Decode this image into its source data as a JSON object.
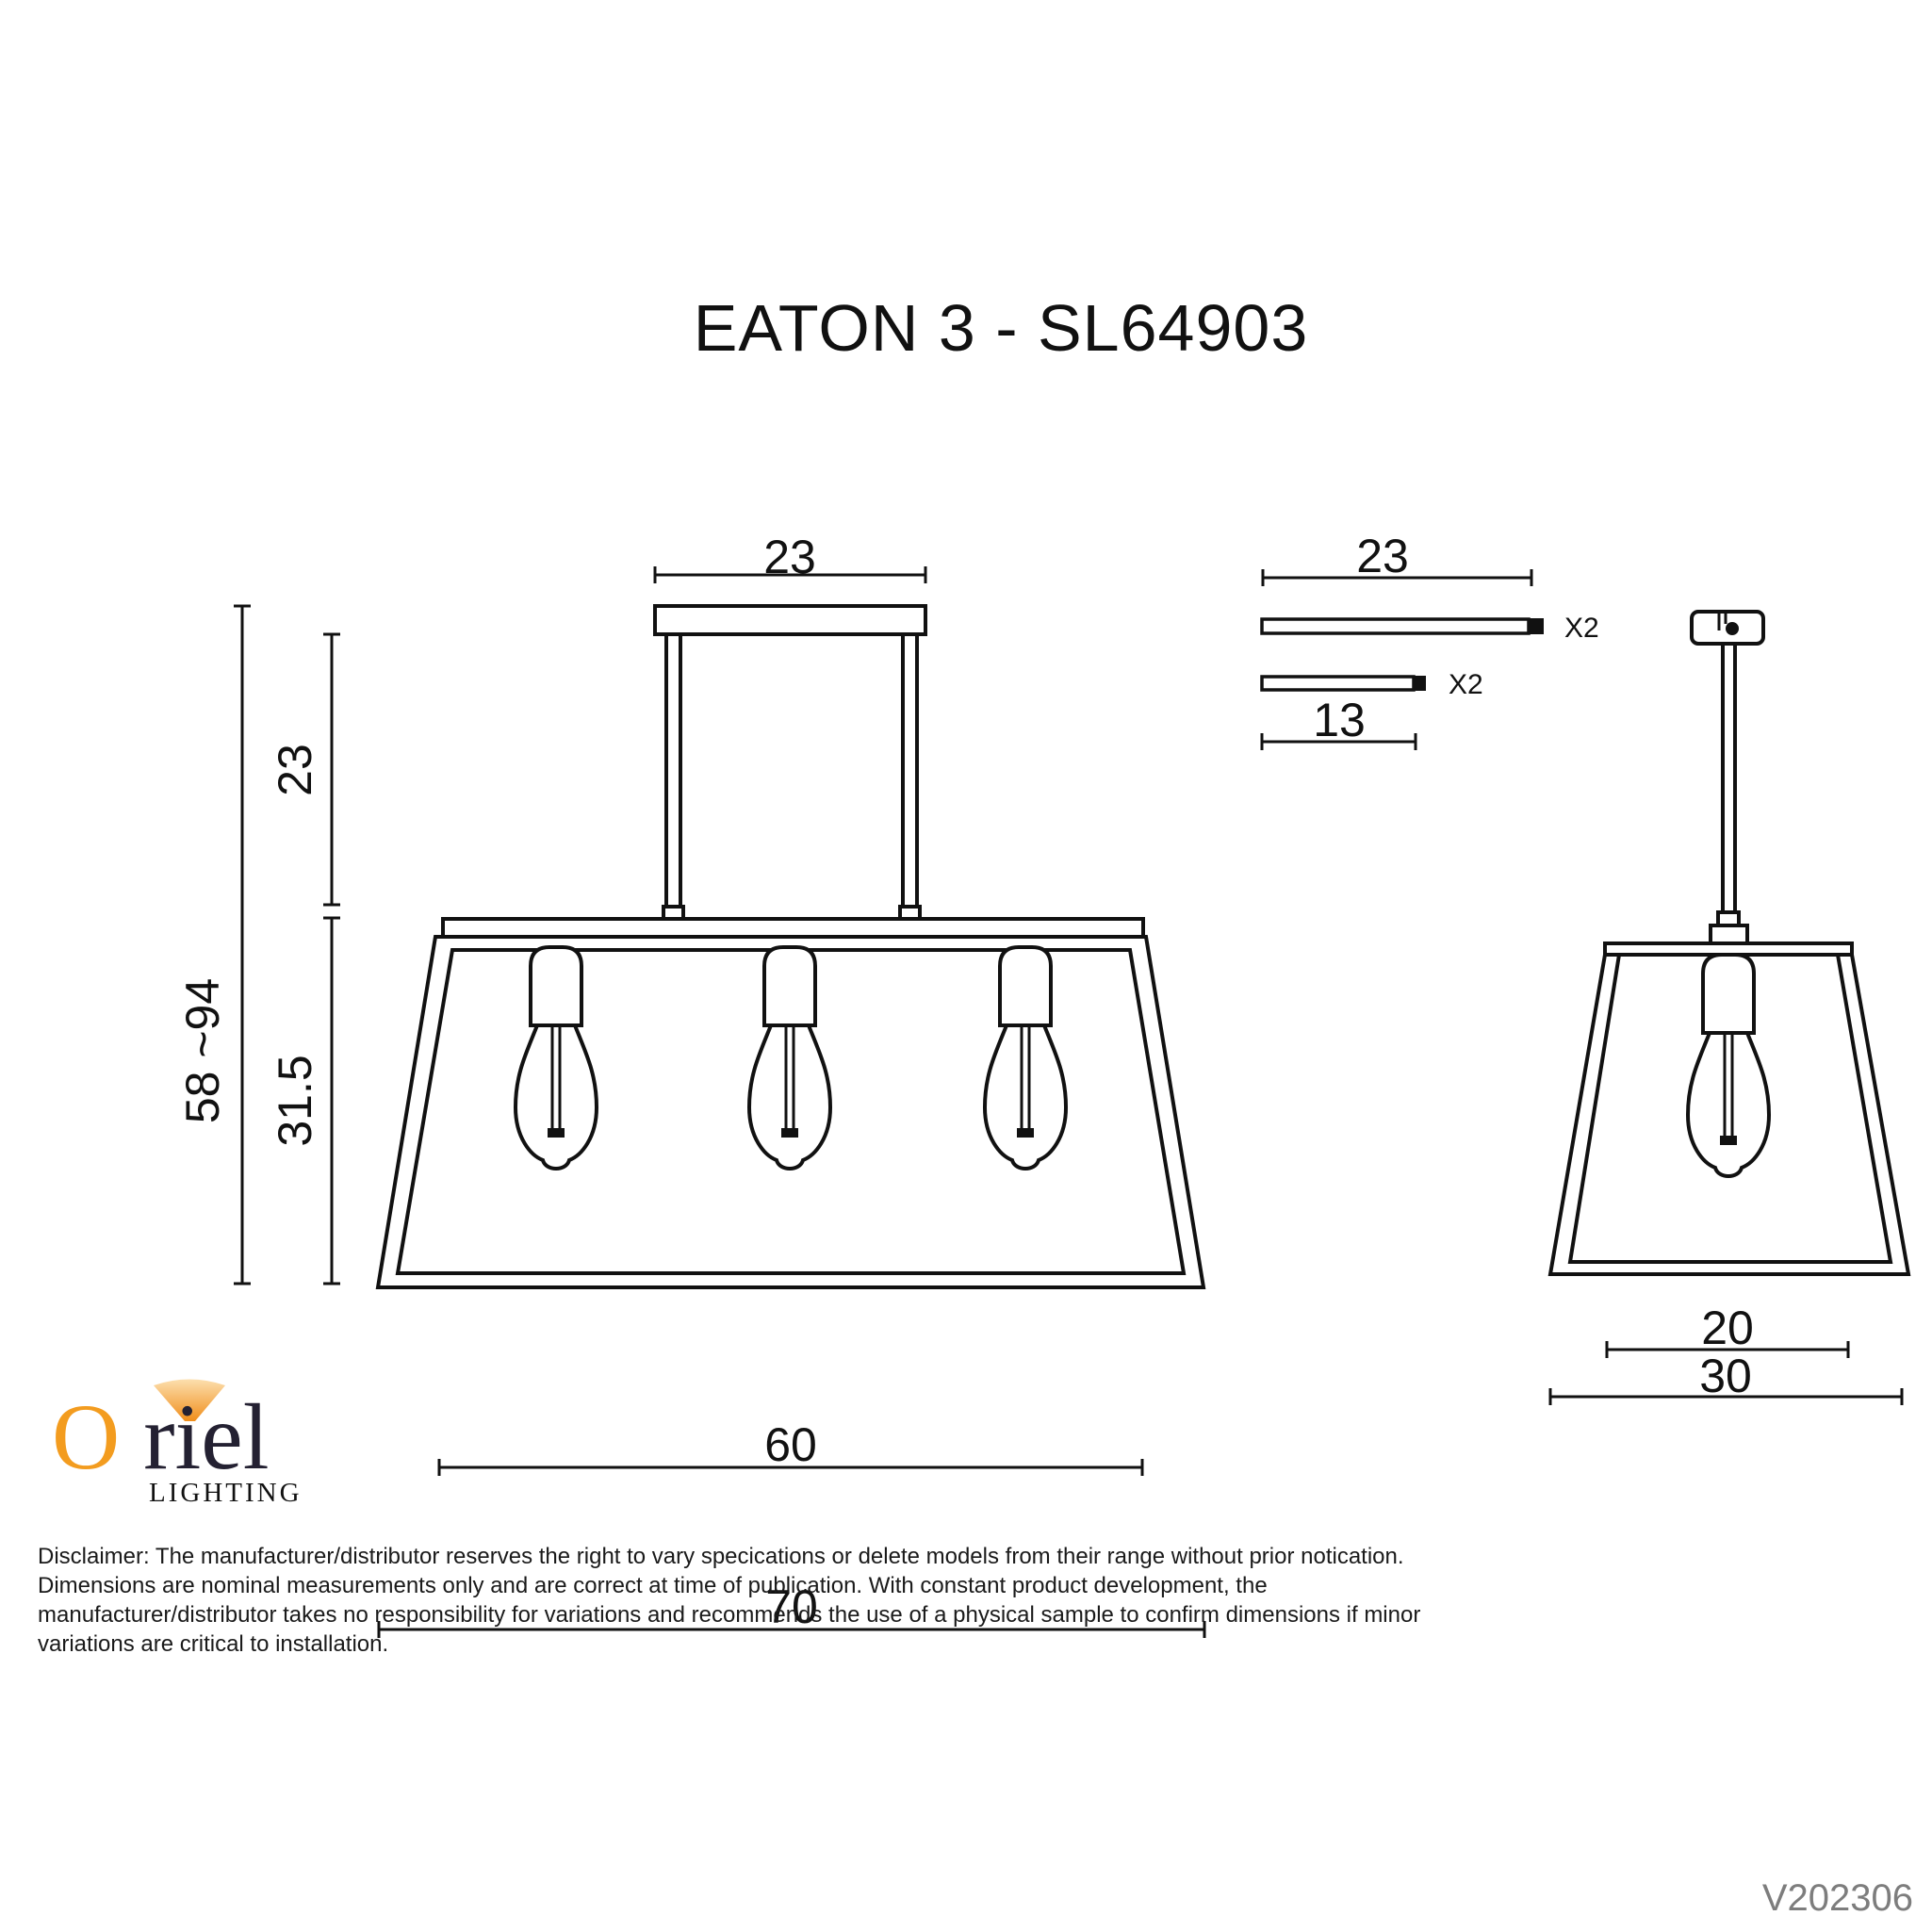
{
  "title": "EATON 3 - SL64903",
  "front_view": {
    "dim_canopy_width": "23",
    "dim_rod_length": "23",
    "dim_overall_height": "58 ~94",
    "dim_shade_height": "31.5",
    "dim_shade_top_width": "60",
    "dim_shade_overall_width": "70"
  },
  "parts": {
    "long_rod": {
      "length": "23",
      "qty": "X2"
    },
    "short_rod": {
      "length": "13",
      "qty": "X2"
    }
  },
  "side_view": {
    "dim_shade_top_depth": "20",
    "dim_shade_bottom_depth": "30"
  },
  "logo": {
    "brand_initial": "O",
    "brand_rest": "riel",
    "tagline": "LIGHTING"
  },
  "disclaimer_lines": [
    "Disclaimer: The manufacturer/distributor reserves the right to vary specications or delete models from their range without prior notication.",
    "Dimensions are nominal measurements only and are correct at time of publication. With constant product development, the",
    "manufacturer/distributor takes no responsibility for variations and recommends the use of a physical sample to confirm dimensions if minor",
    "variations are critical to installation."
  ],
  "version": "V202306",
  "colors": {
    "ink": "#111111",
    "version_gray": "#7d7d7d",
    "logo_orange": "#F39C1F",
    "logo_dark": "#242132"
  }
}
